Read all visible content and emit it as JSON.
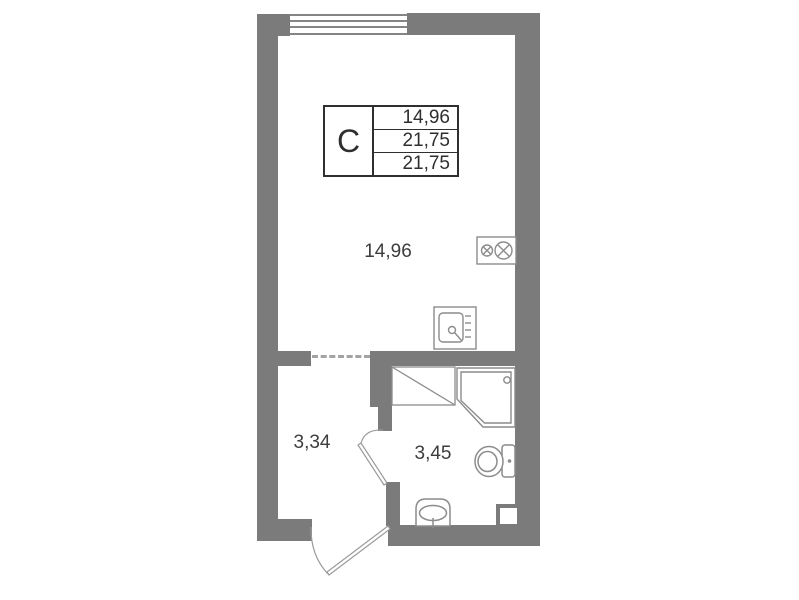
{
  "info_box": {
    "unit_label": "C",
    "rows": [
      "14,96",
      "21,75",
      "21,75"
    ]
  },
  "rooms": [
    {
      "id": "living-room",
      "area_label": "14,96"
    },
    {
      "id": "hallway",
      "area_label": "3,34"
    },
    {
      "id": "bathroom",
      "area_label": "3,45"
    }
  ],
  "elements": [
    "window",
    "entry-door",
    "bathroom-door",
    "dashed-opening",
    "stove-icon",
    "kitchen-sink-icon",
    "washing-machine-icon",
    "shower-cabin-icon",
    "toilet-icon",
    "washbasin-icon",
    "vent-shaft"
  ],
  "colors": {
    "wall": "#7b7b7b",
    "fixture_line": "#8c8c8c",
    "door_line": "#9a9a9a",
    "text": "#3d3d3d",
    "info_border": "#2f2f2f",
    "background": "#ffffff"
  }
}
